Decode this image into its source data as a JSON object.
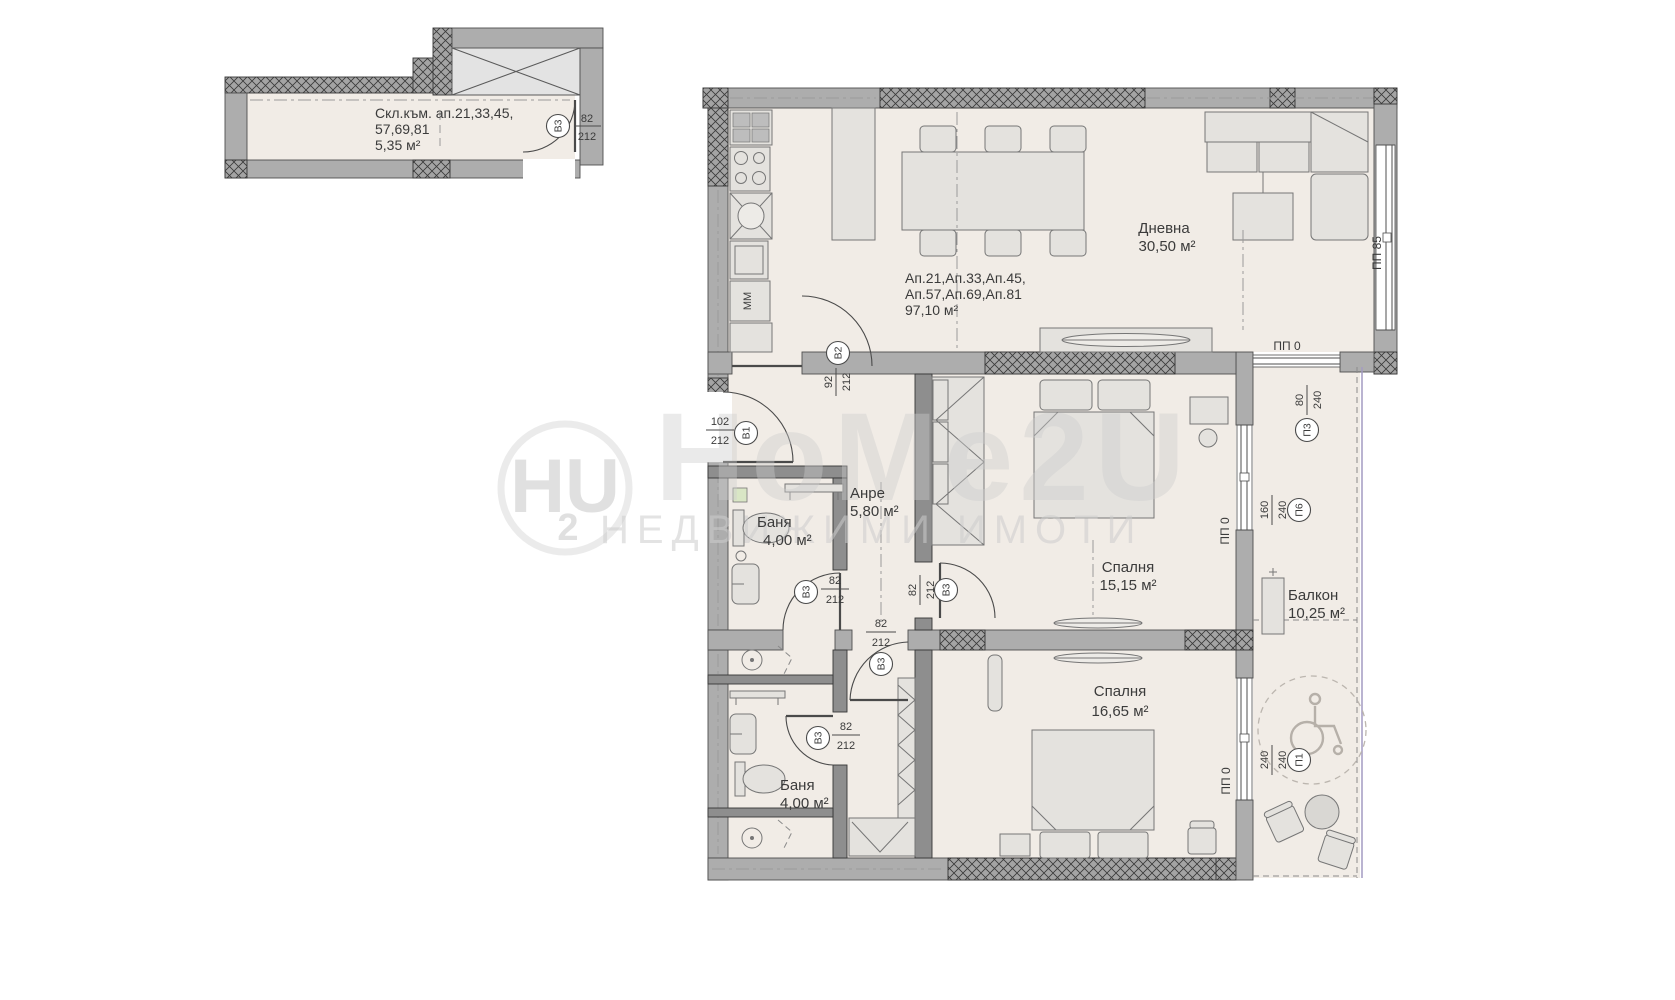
{
  "colors": {
    "background": "#ffffff",
    "floor": "#F1ECE6",
    "wall": "#ADADAD",
    "line": "#4a4a4a",
    "watermark": "#cdcdcd",
    "balcony_rail": "#a39bc2"
  },
  "watermark": {
    "logo_hu": "HU",
    "logo_2": "2",
    "brand": "HoMe2U",
    "tagline": "НЕДВИЖИМИ  ИМОТИ"
  },
  "plan": {
    "storage": {
      "line1": "Скл.към. ап.21,33,45,",
      "line2": "57,69,81",
      "area": "5,35 м²"
    },
    "apartment": {
      "ids1": "Ап.21,Ап.33,Ап.45,",
      "ids2": "Ап.57,Ап.69,Ап.81",
      "area": "97,10 м²"
    },
    "rooms": {
      "living": {
        "name": "Дневна",
        "area": "30,50 м²"
      },
      "hall": {
        "name": "Анре",
        "area": "5,80 м²"
      },
      "bath1": {
        "name": "Баня",
        "area": "4,00 м²"
      },
      "bedroom1": {
        "name": "Спалня",
        "area": "15,15 м²"
      },
      "bedroom2": {
        "name": "Спалня",
        "area": "16,65 м²"
      },
      "bath2": {
        "name": "Баня",
        "area": "4,00 м²"
      },
      "balcony": {
        "name": "Балкон",
        "area": "10,25 м²"
      }
    },
    "doors": {
      "b1": {
        "id": "В1",
        "w": "102",
        "h": "212"
      },
      "b2": {
        "id": "В2",
        "w": "92",
        "h": "212"
      },
      "b3": {
        "id": "В3",
        "w": "82",
        "h": "212"
      }
    },
    "windows": {
      "pp85": {
        "id": "ПП 85"
      },
      "pp0": {
        "id": "ПП 0"
      },
      "p3": {
        "id": "П3",
        "w": "80",
        "h": "240"
      },
      "p6": {
        "id": "П6",
        "w": "160",
        "h": "240"
      },
      "p1": {
        "id": "П1",
        "w": "240",
        "h": "240"
      }
    },
    "kitchen": {
      "appliance": "ММ"
    }
  }
}
